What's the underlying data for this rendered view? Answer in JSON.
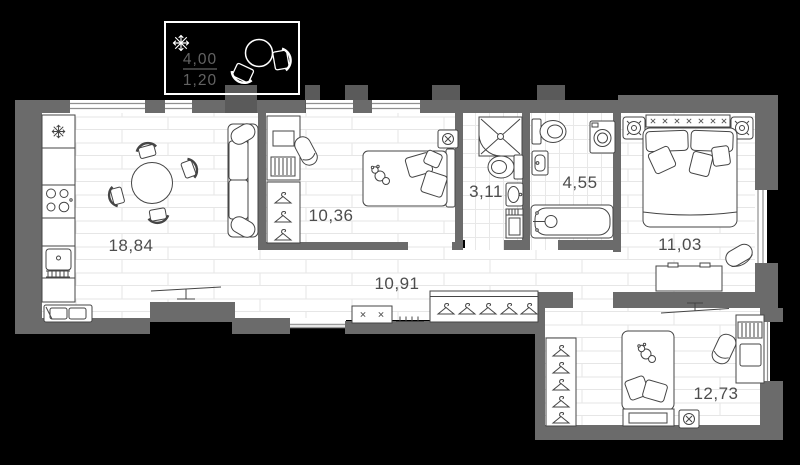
{
  "floor_plan": {
    "type": "apartment-floor-plan",
    "balcony": {
      "area_total": "4,00",
      "area_counted": "1,20"
    },
    "rooms": [
      {
        "name": "kitchen-living-room",
        "area": "18,84"
      },
      {
        "name": "bedroom-1",
        "area": "10,36"
      },
      {
        "name": "shower-room",
        "area": "3,11"
      },
      {
        "name": "bathroom",
        "area": "4,55"
      },
      {
        "name": "bedroom-2",
        "area": "11,03"
      },
      {
        "name": "hallway",
        "area": "10,91"
      },
      {
        "name": "children-room",
        "area": "12,73"
      }
    ],
    "icons": {
      "fridge": "snowflake-icon",
      "balcony_ornament": "snowflake-icon",
      "ventilation": "fan-circle-x-icon",
      "bedside_lamp": "lamp-icon",
      "wardrobe": "hanger-icon"
    },
    "colors": {
      "background": "#000000",
      "wall": "#6b6b6b",
      "outer_pillar": "#5a5a5a",
      "floor": "#ffffff",
      "floor_line": "#e6e6e6",
      "furniture_outline": "#454545",
      "area_label": "#4d4d4d",
      "balcony_border": "#ffffff",
      "balcony_text": "#636363"
    }
  }
}
